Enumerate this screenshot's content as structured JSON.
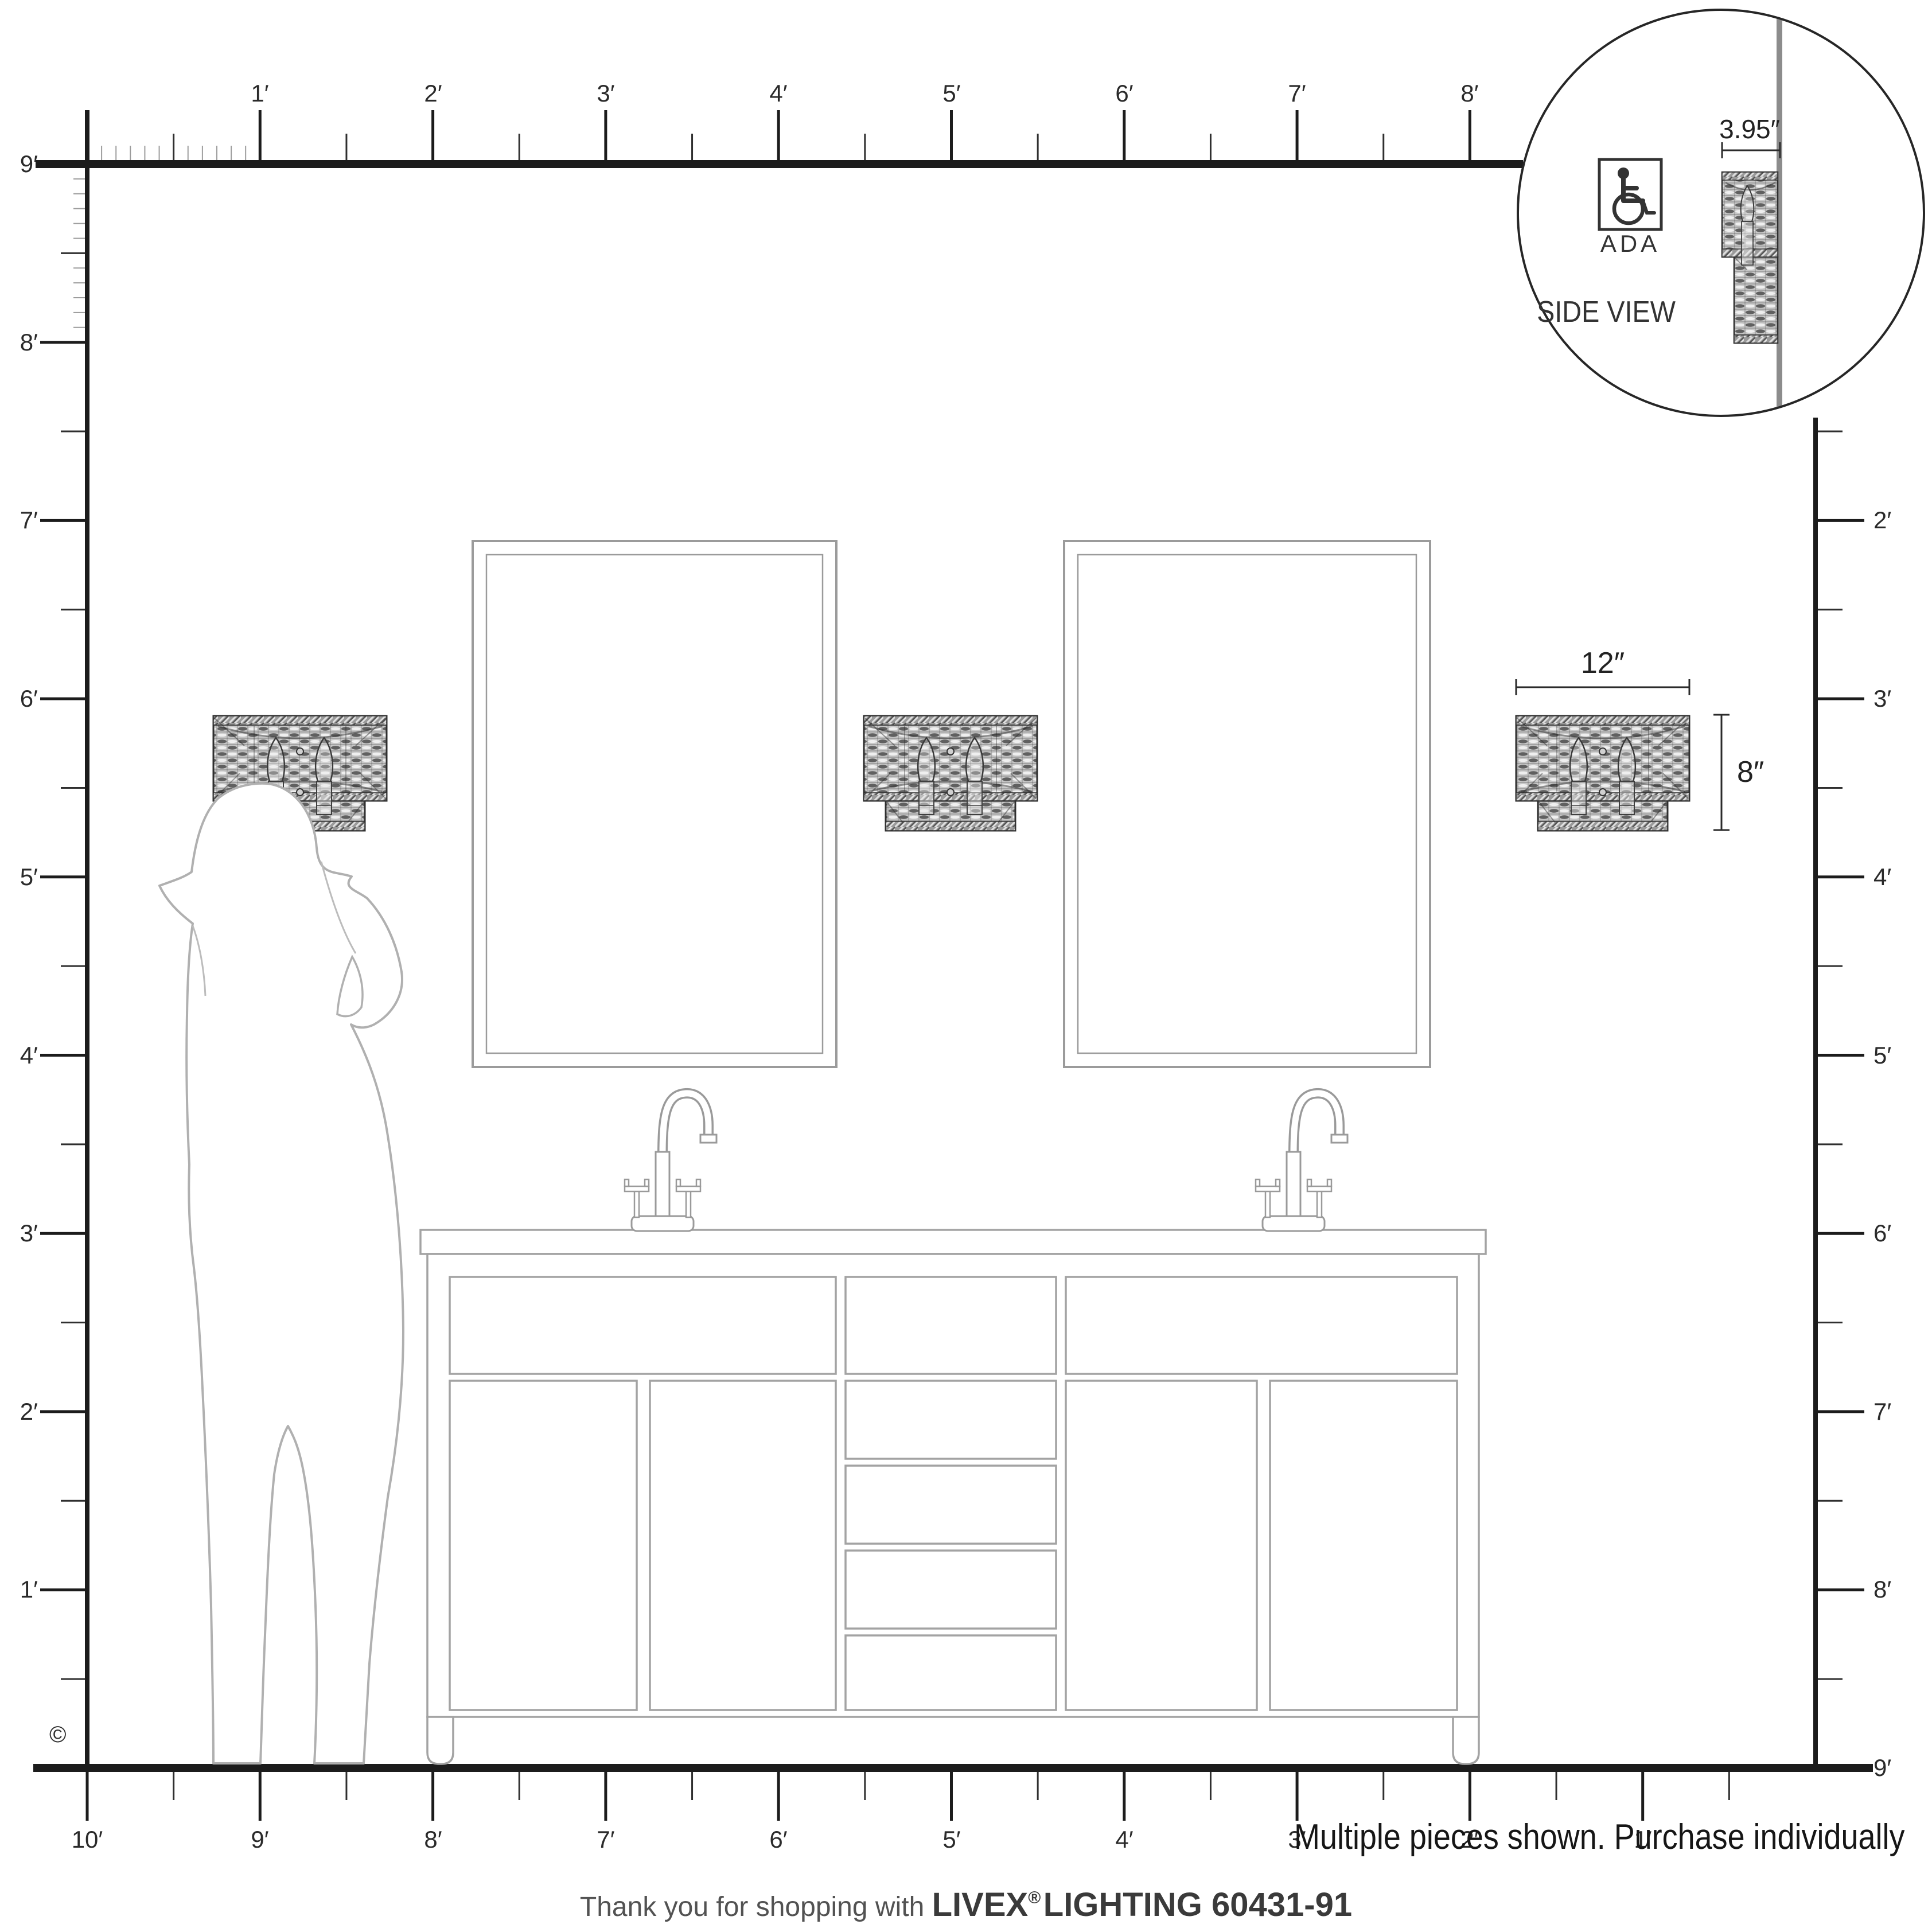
{
  "page": {
    "copyright": "©",
    "note": "Multiple pieces shown. Purchase individually",
    "footer": {
      "thanks": "Thank you for shopping with ",
      "brand": "LIVEX",
      "reg": "®",
      "product": " LIGHTING 60431-91"
    }
  },
  "inset": {
    "depth_label": "3.95″",
    "ada_label": "ADA",
    "view_label": "SIDE VIEW"
  },
  "fixture": {
    "width_label": "12″",
    "height_label": "8″"
  },
  "rulers": {
    "top": [
      "1′",
      "2′",
      "3′",
      "4′",
      "5′",
      "6′",
      "7′",
      "8′"
    ],
    "left_ceiling": "9′",
    "left": [
      "8′",
      "7′",
      "6′",
      "5′",
      "4′",
      "3′",
      "2′",
      "1′"
    ],
    "right": [
      "2′",
      "3′",
      "4′",
      "5′",
      "6′",
      "7′",
      "8′"
    ],
    "right_floor": "9′",
    "bottom": [
      "10′",
      "9′",
      "8′",
      "7′",
      "6′",
      "5′",
      "4′",
      "3′",
      "2′",
      "1′"
    ]
  }
}
